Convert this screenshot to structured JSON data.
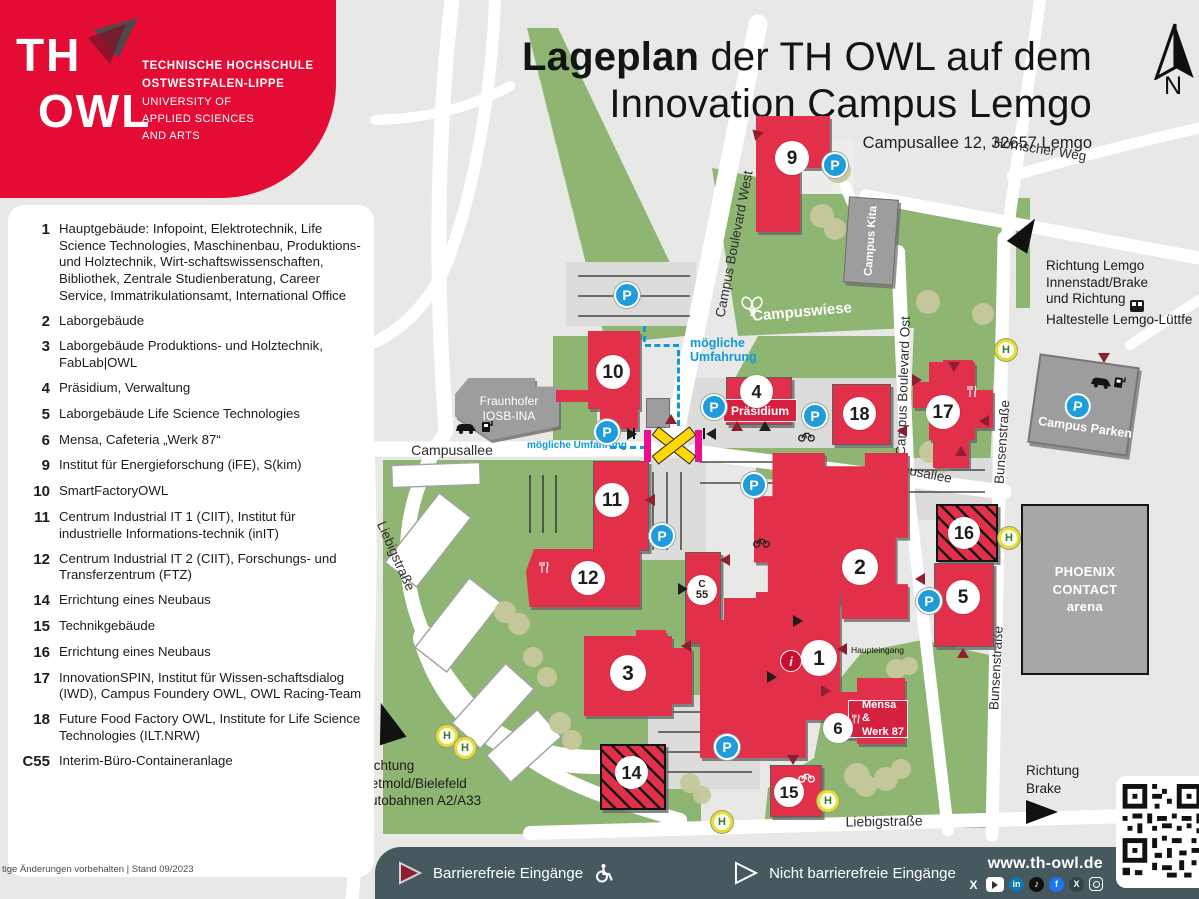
{
  "logo": {
    "th": "TH",
    "owl": "OWL",
    "line1": "TECHNISCHE HOCHSCHULE",
    "line2": "OSTWESTFALEN-LIPPE",
    "line3": "UNIVERSITY OF",
    "line4": "APPLIED SCIENCES",
    "line5": "AND ARTS"
  },
  "title": {
    "bold": "Lageplan",
    "rest": " der TH OWL auf dem",
    "line2": "Innovation Campus Lemgo",
    "address": "Campusallee 12, 32657 Lemgo"
  },
  "compass": {
    "n": "N"
  },
  "legend": {
    "items": [
      {
        "num": "1",
        "text": "Hauptgebäude: Infopoint, Elektrotechnik, Life Science Technologies, Maschinenbau, Produktions- und Holztechnik, Wirt-schaftswissenschaften, Bibliothek, Zentrale Studienberatung, Career Service, Immatrikulationsamt, International Office"
      },
      {
        "num": "2",
        "text": "Laborgebäude"
      },
      {
        "num": "3",
        "text": "Laborgebäude Produktions- und Holztechnik, FabLab|OWL"
      },
      {
        "num": "4",
        "text": "Präsidium, Verwaltung"
      },
      {
        "num": "5",
        "text": "Laborgebäude Life Science Technologies"
      },
      {
        "num": "6",
        "text": "Mensa, Cafeteria „Werk 87“"
      },
      {
        "num": "9",
        "text": "Institut für Energieforschung (iFE), S(kim)"
      },
      {
        "num": "10",
        "text": "SmartFactoryOWL"
      },
      {
        "num": "11",
        "text": "Centrum Industrial IT 1 (CIIT), Institut für industrielle Informations-technik (inIT)"
      },
      {
        "num": "12",
        "text": "Centrum Industrial IT 2 (CIIT), Forschungs- und Transferzentrum (FTZ)"
      },
      {
        "num": "14",
        "text": "Errichtung eines Neubaus"
      },
      {
        "num": "15",
        "text": "Technikgebäude"
      },
      {
        "num": "16",
        "text": "Errichtung eines Neubaus"
      },
      {
        "num": "17",
        "text": "InnovationSPIN, Institut für Wissen-schaftsdialog (IWD), Campus Foundery OWL, OWL Racing-Team"
      },
      {
        "num": "18",
        "text": "Future Food Factory OWL, Institute for Life Science Technologies (ILT.NRW)"
      },
      {
        "num": "C55",
        "text": "Interim-Büro-Containeranlage"
      }
    ]
  },
  "map": {
    "streets": {
      "campusallee_w": "Campusallee",
      "campusallee_e": "Campusallee",
      "blvd_west": "Campus Boulevard West",
      "blvd_ost": "Campus Boulevard Ost",
      "hornscher_weg": "Hornscher Weg",
      "bunsen_n": "Bunsenstraße",
      "bunsen_s": "Bunsenstraße",
      "liebig_w": "Liebigstraße",
      "liebig_s": "Liebigstraße"
    },
    "areas": {
      "campuswiese": "Campuswiese",
      "kita": "Campus Kita",
      "fraunhofer_l1": "Fraunhofer",
      "fraunhofer_l2": "IOSB-INA",
      "parken": "Campus Parken",
      "arena_l1": "PHOENIX",
      "arena_l2": "CONTACT",
      "arena_l3": "arena"
    },
    "badges": {
      "b1": "1",
      "b2": "2",
      "b3": "3",
      "b4": "4",
      "b5": "5",
      "b6": "6",
      "b9": "9",
      "b10": "10",
      "b11": "11",
      "b12": "12",
      "b14": "14",
      "b15": "15",
      "b16": "16",
      "b17": "17",
      "b18": "18",
      "c55_l1": "C",
      "c55_l2": "55"
    },
    "labels": {
      "praesidium": "Präsidium",
      "mensa_l1": "Mensa &",
      "mensa_l2": "Werk 87",
      "haupteingang": "Haupteingang",
      "umfahrung_l1": "mögliche",
      "umfahrung_l2": "Umfahrung",
      "umfahrung_inline": "mögliche Umfahrung"
    },
    "directions": {
      "detmold_l1": "Richtung",
      "detmold_l2": "Detmold/Bielefeld",
      "detmold_l3": "Autobahnen A2/A33",
      "brake_l1": "Richtung",
      "brake_l2": "Brake",
      "lemgo_l1": "Richtung Lemgo",
      "lemgo_l2": "Innenstadt/Brake",
      "lemgo_l3": "und Richtung",
      "lemgo_l4": "Haltestelle Lemgo-Lüttfe"
    },
    "icons": {
      "parking": "P",
      "bus_stop": "H",
      "info": "i"
    }
  },
  "footer": {
    "barrier_free": "Barrierefreie Eingänge",
    "not_barrier_free": "Nicht barrierefreie Eingänge",
    "website": "www.th-owl.de",
    "revision": "tige Änderungen vorbehalten | Stand 09/2023",
    "social": {
      "x": "X",
      "linkedin": "in",
      "facebook": "f",
      "xing": "X",
      "tiktok": "♪"
    }
  },
  "colors": {
    "brand_red": "#e40b34",
    "building_red": "#e2304a",
    "label_red": "#d62040",
    "map_green": "#8fb573",
    "tree_olive": "#c6c99c",
    "parking_blue": "#1f9cd9",
    "detour_blue": "#0f9ad7",
    "entrance_red": "#8e1f31",
    "crossing_yellow": "#ffd803",
    "crossing_magenta": "#ec0e8d",
    "bar_slate": "#46595f",
    "building_gray": "#9d9d9d"
  }
}
